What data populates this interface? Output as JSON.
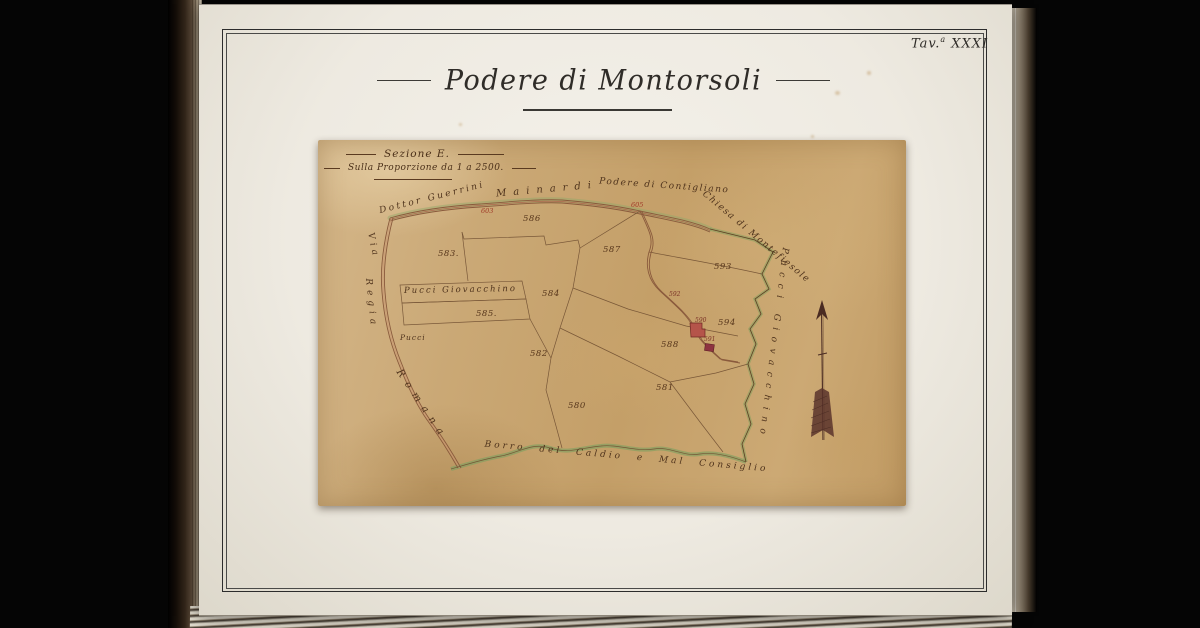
{
  "page": {
    "plate_prefix": "Tav.",
    "plate_sup": "a",
    "plate_numeral": "XXXI",
    "title": "Podere di Montorsoli"
  },
  "map": {
    "section_label": "Sezione E.",
    "scale_label": "Sulla Proporzione da 1 a 2500.",
    "labels": {
      "owner_top_left": "Dottor Guerrini",
      "road_top": "Mainardi",
      "estate_top": "Podere di Contigliano",
      "church_top_right": "Chiesa di Montefiesole",
      "owner_right": "Pucci Giovacchino",
      "road_left_1": "Via",
      "road_left_2": "Regia",
      "road_left_3": "Romana",
      "stream_bottom": "Borro del Caldio e Mal Consiglio",
      "strip_owner": "Pucci Giovacchino",
      "strip_owner_small": "Pucci"
    },
    "parcel_numbers": [
      {
        "label": "580",
        "x": 250,
        "y": 268,
        "cls": "pn"
      },
      {
        "label": "581",
        "x": 338,
        "y": 250,
        "cls": "pn"
      },
      {
        "label": "582",
        "x": 212,
        "y": 216,
        "cls": "pn"
      },
      {
        "label": "583.",
        "x": 120,
        "y": 116,
        "cls": "pn"
      },
      {
        "label": "584",
        "x": 224,
        "y": 156,
        "cls": "pn"
      },
      {
        "label": "585.",
        "x": 158,
        "y": 176,
        "cls": "pn"
      },
      {
        "label": "586",
        "x": 205,
        "y": 81,
        "cls": "pn"
      },
      {
        "label": "587",
        "x": 285,
        "y": 112,
        "cls": "pn"
      },
      {
        "label": "588",
        "x": 343,
        "y": 207,
        "cls": "pn"
      },
      {
        "label": "593",
        "x": 396,
        "y": 129,
        "cls": "pn"
      },
      {
        "label": "594",
        "x": 400,
        "y": 185,
        "cls": "pn"
      },
      {
        "label": "590",
        "x": 377,
        "y": 182,
        "cls": "pn-tiny"
      },
      {
        "label": "591",
        "x": 386,
        "y": 201,
        "cls": "pn-tiny"
      },
      {
        "label": "592",
        "x": 351,
        "y": 156,
        "cls": "pn-tiny"
      },
      {
        "label": "603",
        "x": 163,
        "y": 73,
        "cls": "pn-red"
      },
      {
        "label": "605",
        "x": 313,
        "y": 67,
        "cls": "pn-red"
      }
    ],
    "icons": {
      "north_arrow": "north-arrow"
    }
  }
}
